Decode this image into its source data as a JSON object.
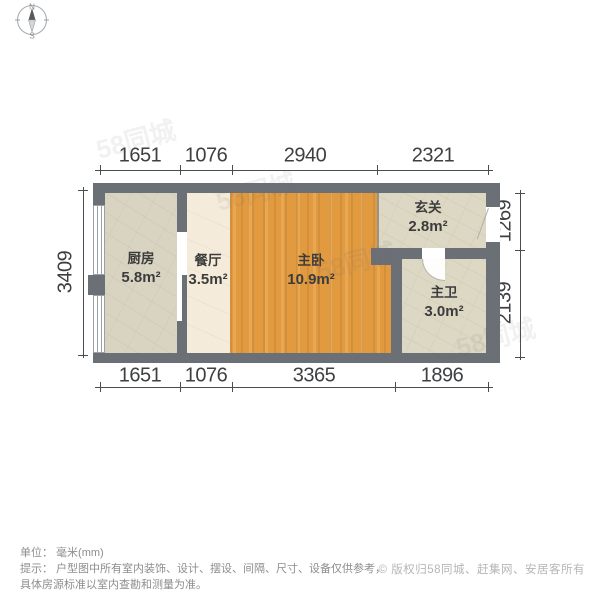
{
  "compass": {
    "north": "N",
    "south": "S"
  },
  "dimensions": {
    "unit": "mm",
    "top": [
      "1651",
      "1076",
      "2940",
      "2321"
    ],
    "bottom": [
      "1651",
      "1076",
      "3365",
      "1896"
    ],
    "left": [
      "3409"
    ],
    "right": [
      "1269",
      "2139"
    ]
  },
  "rooms": {
    "kitchen": {
      "name": "厨房",
      "area": "5.8m²"
    },
    "dining": {
      "name": "餐厅",
      "area": "3.5m²"
    },
    "bedroom": {
      "name": "主卧",
      "area": "10.9m²"
    },
    "entry": {
      "name": "玄关",
      "area": "2.8m²"
    },
    "bathroom": {
      "name": "主卫",
      "area": "3.0m²"
    }
  },
  "footer": {
    "unit_line": "单位： 毫米(mm)",
    "tip_line1": "提示： 户型图中所有室内装饰、设计、摆设、间隔、尺寸、设备仅供参考，",
    "tip_line2": "具体房源标准以室内查勘和测量为准。",
    "copyright": "© 版权归58同城、赶集网、安居客所有"
  },
  "watermark": {
    "text": "58同城"
  },
  "colors": {
    "wall": "#6b7076",
    "kitchen_floor": "#d9d4c2",
    "dining_floor": "#f4ebda",
    "bedroom_floor": "#e29a40",
    "beige_floor": "#dcd8c4",
    "dim_text": "#3d3f41",
    "footer_text": "#8d8d8d",
    "copyright_text": "#b6b6b6"
  }
}
